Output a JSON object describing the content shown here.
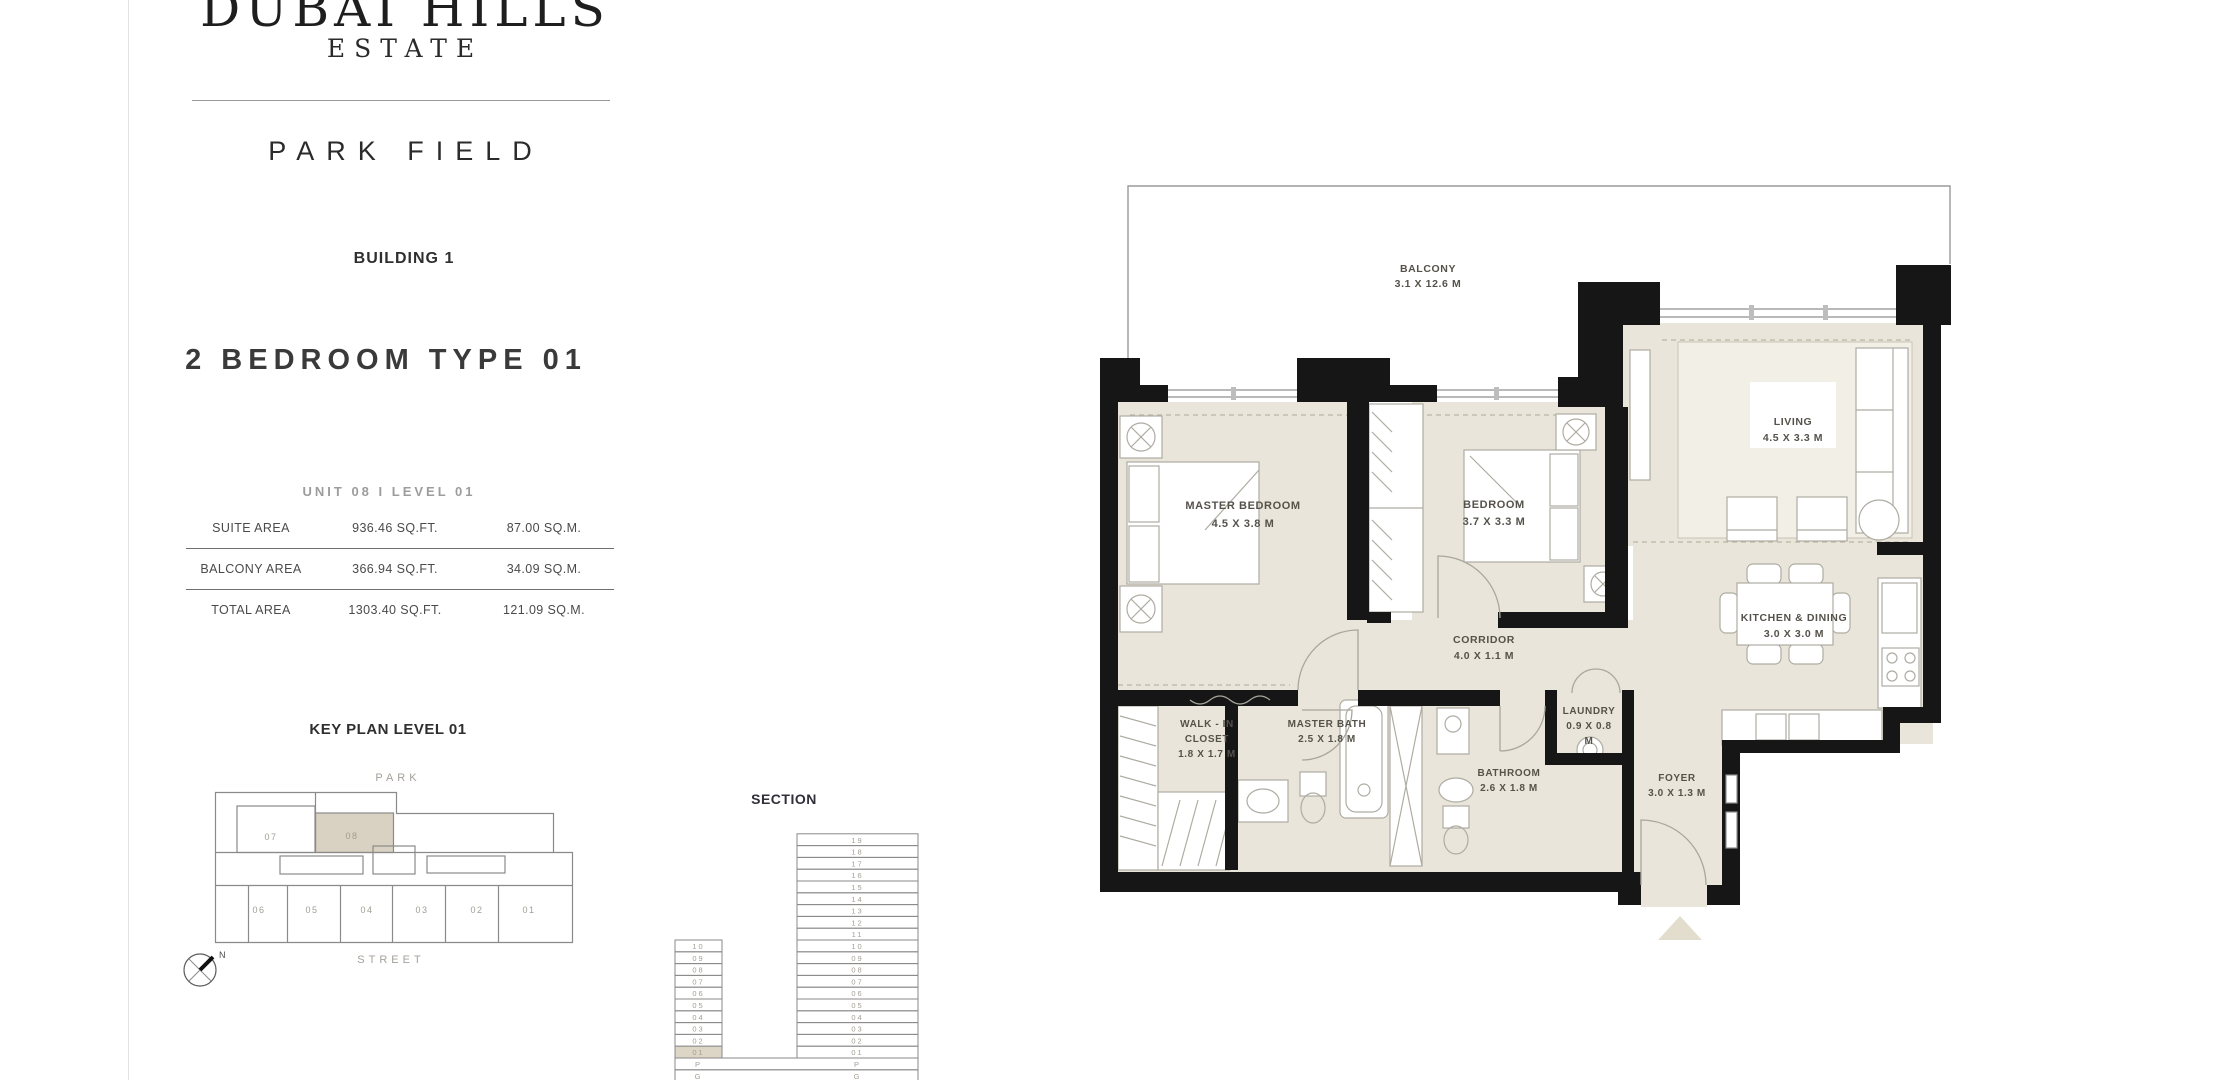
{
  "brand": {
    "line1": "DUBAI HILLS",
    "line2": "ESTATE",
    "project": "PARK FIELD",
    "building": "BUILDING 1"
  },
  "unit": {
    "type_title": "2 BEDROOM TYPE 01",
    "unit_level": "UNIT 08 I LEVEL 01"
  },
  "area_table": {
    "rows": [
      {
        "label": "SUITE AREA",
        "sqft": "936.46 SQ.FT.",
        "sqm": "87.00 SQ.M."
      },
      {
        "label": "BALCONY AREA",
        "sqft": "366.94 SQ.FT.",
        "sqm": "34.09 SQ.M."
      },
      {
        "label": "TOTAL AREA",
        "sqft": "1303.40 SQ.FT.",
        "sqm": "121.09 SQ.M."
      }
    ]
  },
  "key_plan": {
    "title": "KEY PLAN LEVEL 01",
    "top_label": "PARK",
    "bottom_label": "STREET",
    "compass": "N",
    "units_top": [
      "07",
      "08"
    ],
    "highlighted_unit": "08",
    "units_bottom": [
      "06",
      "05",
      "04",
      "03",
      "02",
      "01"
    ]
  },
  "section": {
    "title": "SECTION",
    "left_tower_floors": [
      "10",
      "09",
      "08",
      "07",
      "06",
      "05",
      "04",
      "03",
      "02",
      "01"
    ],
    "right_tower_floors": [
      "19",
      "18",
      "17",
      "16",
      "15",
      "14",
      "13",
      "12",
      "11",
      "10",
      "09",
      "08",
      "07",
      "06",
      "05",
      "04",
      "03",
      "02",
      "01"
    ],
    "base_levels": [
      "P",
      "G"
    ],
    "highlighted_floor": "01"
  },
  "floor_plan": {
    "rooms": [
      {
        "id": "balcony",
        "lines": [
          "BALCONY",
          "3.1 X 12.6 M"
        ]
      },
      {
        "id": "master_bedroom",
        "lines": [
          "MASTER BEDROOM",
          "4.5 X 3.8 M"
        ]
      },
      {
        "id": "bedroom",
        "lines": [
          "BEDROOM",
          "3.7 X 3.3 M"
        ]
      },
      {
        "id": "living",
        "lines": [
          "LIVING",
          "4.5 X 3.3 M"
        ]
      },
      {
        "id": "kitchen_dining",
        "lines": [
          "KITCHEN & DINING",
          "3.0 X 3.0 M"
        ]
      },
      {
        "id": "corridor",
        "lines": [
          "CORRIDOR",
          "4.0 X 1.1 M"
        ]
      },
      {
        "id": "walk_in_closet",
        "lines": [
          "WALK - IN",
          "CLOSET",
          "1.8 X 1.7 M"
        ]
      },
      {
        "id": "master_bath",
        "lines": [
          "MASTER BATH",
          "2.5 X 1.8 M"
        ]
      },
      {
        "id": "bathroom",
        "lines": [
          "BATHROOM",
          "2.6 X 1.8 M"
        ]
      },
      {
        "id": "laundry",
        "lines": [
          "LAUNDRY",
          "0.9 X 0.8",
          "M"
        ]
      },
      {
        "id": "foyer",
        "lines": [
          "FOYER",
          "3.0 X 1.3 M"
        ]
      }
    ]
  },
  "colors": {
    "floor": "#e9e5da",
    "carpet": "#f2efe7",
    "wall": "#161616",
    "outline": "#8a8a8a",
    "highlight": "#d9d1c1",
    "furniture_line": "#aeaca2",
    "dashed_line": "#bcb6a4",
    "text_dark": "#3a3a3a",
    "text_gray": "#9c9c9c",
    "label": "#55524a"
  }
}
